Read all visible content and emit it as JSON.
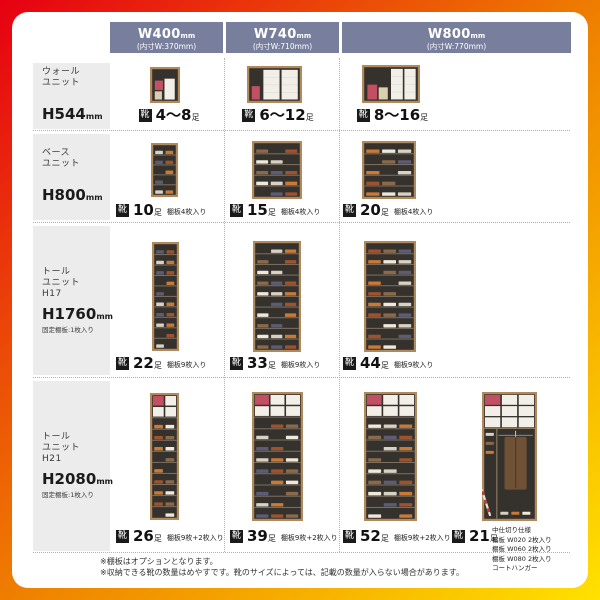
{
  "header": {
    "columns": [
      {
        "title": "W400",
        "unit": "mm",
        "sub": "(内寸W:370mm)"
      },
      {
        "title": "W740",
        "unit": "mm",
        "sub": "(内寸W:710mm)"
      },
      {
        "title": "W800",
        "unit": "mm",
        "sub": "(内寸W:770mm)"
      }
    ]
  },
  "labels": {
    "shoe_badge": "靴",
    "count_unit": "足"
  },
  "rows": [
    {
      "side": {
        "line1": "ウォール",
        "line2": "ユニット",
        "line3": "",
        "height": "H544",
        "height_unit": "mm",
        "note": ""
      },
      "cells": [
        {
          "count": "4〜8",
          "note": "",
          "cabinet": {
            "type": "boxes",
            "variant": 1,
            "w": 30,
            "h": 36
          }
        },
        {
          "count": "6〜12",
          "note": "",
          "cabinet": {
            "type": "boxes",
            "variant": 2,
            "w": 55,
            "h": 37
          }
        },
        {
          "count": "8〜16",
          "note": "",
          "cabinet": {
            "type": "boxes",
            "variant": 3,
            "w": 58,
            "h": 38
          }
        }
      ]
    },
    {
      "side": {
        "line1": "ベース",
        "line2": "ユニット",
        "line3": "",
        "height": "H800",
        "height_unit": "mm",
        "note": ""
      },
      "cells": [
        {
          "count": "10",
          "note": "棚板4枚入り",
          "cabinet": {
            "type": "shelves",
            "levels": 5,
            "cols": 2,
            "seed": 0,
            "w": 27,
            "h": 54
          }
        },
        {
          "count": "15",
          "note": "棚板4枚入り",
          "cabinet": {
            "type": "shelves",
            "levels": 5,
            "cols": 3,
            "seed": 1,
            "w": 50,
            "h": 58
          }
        },
        {
          "count": "20",
          "note": "棚板4枚入り",
          "cabinet": {
            "type": "shelves",
            "levels": 5,
            "cols": 3,
            "seed": 2,
            "w": 54,
            "h": 58
          }
        }
      ]
    },
    {
      "side": {
        "line1": "トール",
        "line2": "ユニット",
        "line3": "H17",
        "height": "H1760",
        "height_unit": "mm",
        "note": "固定棚板:1枚入り"
      },
      "cells": [
        {
          "count": "22",
          "note": "棚板9枚入り",
          "cabinet": {
            "type": "shelves",
            "levels": 10,
            "cols": 2,
            "seed": 3,
            "w": 27,
            "h": 109
          }
        },
        {
          "count": "33",
          "note": "棚板9枚入り",
          "cabinet": {
            "type": "shelves",
            "levels": 10,
            "cols": 3,
            "seed": 4,
            "w": 48,
            "h": 111
          }
        },
        {
          "count": "44",
          "note": "棚板9枚入り",
          "cabinet": {
            "type": "shelves",
            "levels": 10,
            "cols": 3,
            "seed": 5,
            "w": 52,
            "h": 111
          }
        }
      ]
    },
    {
      "side": {
        "line1": "トール",
        "line2": "ユニット",
        "line3": "H21",
        "height": "H2080",
        "height_unit": "mm",
        "note": "固定棚板:1枚入り"
      },
      "cells": [
        {
          "count": "26",
          "note": "棚板9枚+2枚入り",
          "cabinet": {
            "type": "mixed",
            "levels": 9,
            "cols": 2,
            "seed": 6,
            "w": 29,
            "h": 127
          }
        },
        {
          "count": "39",
          "note": "棚板9枚+2枚入り",
          "cabinet": {
            "type": "mixed",
            "levels": 9,
            "cols": 3,
            "seed": 7,
            "w": 51,
            "h": 129
          }
        },
        {
          "count": "52",
          "note": "棚板9枚+2枚入り",
          "cabinet": {
            "type": "mixed",
            "levels": 9,
            "cols": 3,
            "seed": 8,
            "w": 53,
            "h": 129
          }
        },
        {
          "count": "21",
          "note": "",
          "note_lines": [
            "中仕切り仕様",
            "棚板 W020 2枚入り",
            "棚板 W060 2枚入り",
            "棚板 W080 2枚入り",
            "コートハンガー"
          ],
          "cabinet": {
            "type": "coat",
            "w": 55,
            "h": 129
          }
        }
      ]
    }
  ],
  "footnotes": [
    "※棚板はオプションとなります。",
    "※収納できる靴の数量はめやすです。靴のサイズによっては、記載の数量が入らない場合があります。"
  ],
  "colors": {
    "frame_gradient": [
      "#e60012",
      "#ef8200",
      "#ffe100"
    ],
    "header_bg": "#787f9d",
    "sidebar_bg": "#ececec",
    "badge_bg": "#1a1a1a",
    "cabinet_frame": "#b08a5c",
    "cabinet_interior": "#35322e",
    "shelf_line": "#7d7060",
    "box_red": "#c25062",
    "box_white": "#f2efe8",
    "box_beige": "#d9cead",
    "coat_brown": "#6f5236",
    "shoe_palette": [
      "#d8d2c4",
      "#8a6a4a",
      "#c97a36",
      "#5c5c74",
      "#efe9dc",
      "#a0522d"
    ]
  }
}
